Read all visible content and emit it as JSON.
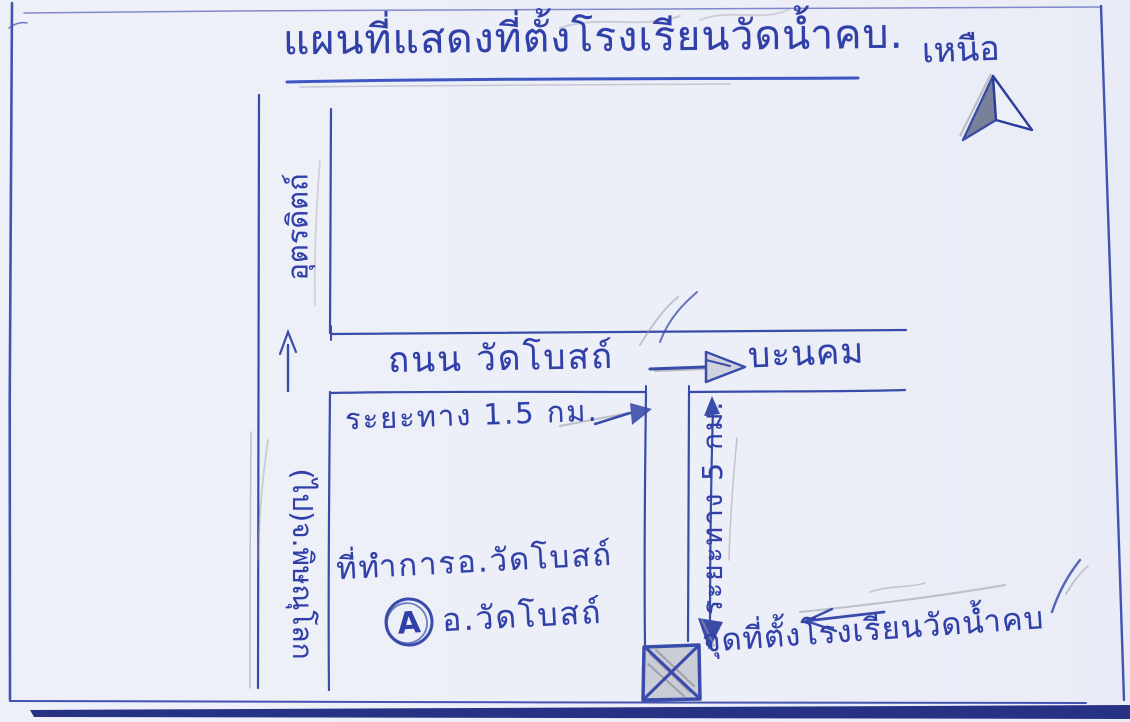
{
  "title": {
    "text": "แผนที่แสดงที่ตั้งโรงเรียนวัดน้ำคบ."
  },
  "compass": {
    "label": "เหนือ",
    "icon": "north-arrow-icon"
  },
  "roads": {
    "highway": {
      "north_label": "อุตรดิตถ์",
      "south_label": "(ไป)จ.พิษณุโลก",
      "direction_icon": "up-arrow-icon"
    },
    "main_road": {
      "name": "ถนน วัดโบสถ์",
      "east_destination": "บะนคม",
      "east_icon": "right-arrow-icon",
      "distance": "ระยะทาง 1.5 กม.",
      "distance_icon": "right-arrow-icon"
    },
    "school_road": {
      "distance": "ระยะทาง 5 กม.",
      "icon": "double-vertical-arrow-icon"
    }
  },
  "landmarks": {
    "district_office": {
      "caption": "ที่ทำการอ.วัดโบสถ์",
      "symbol_icon": "circled-A-icon",
      "symbol_char": "A",
      "label": "อ.วัดโบสถ์"
    },
    "school": {
      "marker_icon": "crossed-box-icon",
      "pointer_icon": "left-arrow-icon",
      "label": "จุดที่ตั้งโรงเรียนวัดน้ำคบ"
    }
  },
  "colors": {
    "ink": "#3a4caa",
    "ink_dark": "#2c3c9c",
    "pencil": "#97979f",
    "paper": "#edeff8",
    "edge_bar": "#273285",
    "underline": "#3d56c4"
  }
}
